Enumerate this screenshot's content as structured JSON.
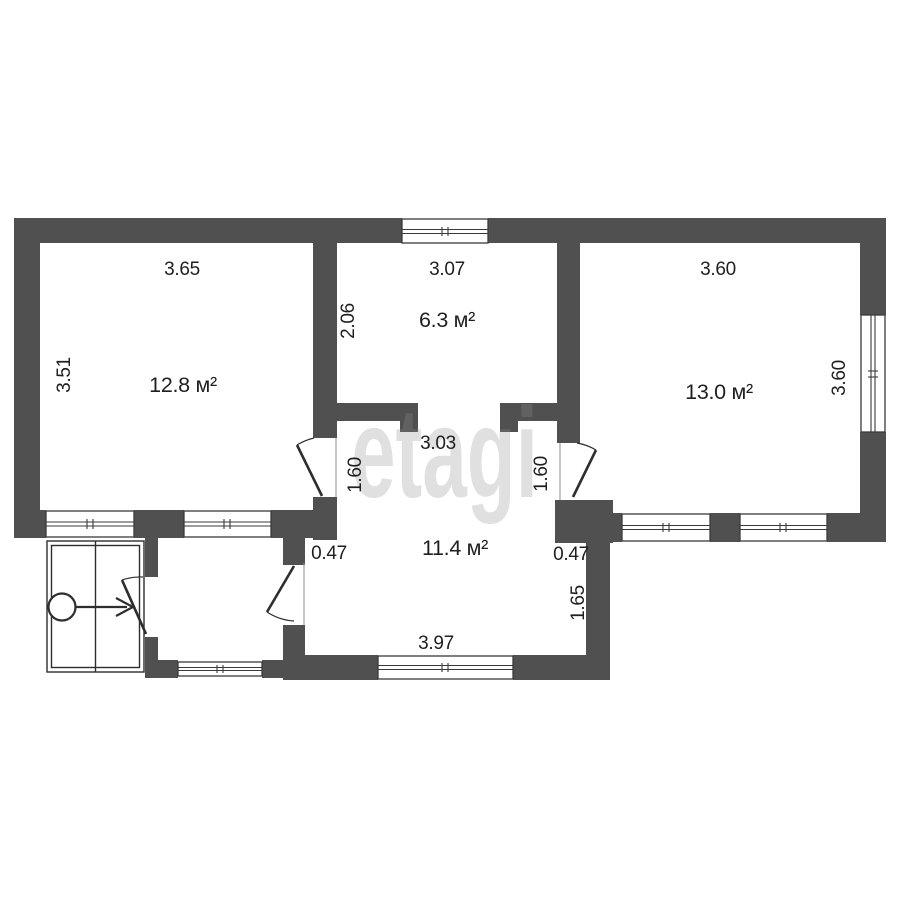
{
  "watermark": {
    "text": "etagi"
  },
  "colors": {
    "background": "#ffffff",
    "wall": "#505050",
    "line": "#2e2e2e",
    "text": "#1f1f1f",
    "watermark": "#8f8f8f"
  },
  "rooms": [
    {
      "area": "12.8 м²",
      "width_label": "3.65",
      "height_label": "3.51"
    },
    {
      "area": "6.3 м²",
      "width_label": "3.07",
      "height_label": "2.06"
    },
    {
      "area": "13.0 м²",
      "width_label": "3.60",
      "height_label": "3.60"
    },
    {
      "area": "11.4 м²",
      "top_width_label": "3.03",
      "bottom_width_label": "3.97",
      "left_door_label": "1.60",
      "right_door_label": "1.60",
      "left_notch_label": "0.47",
      "right_notch_label": "0.47",
      "right_wall_label": "1.65"
    }
  ]
}
